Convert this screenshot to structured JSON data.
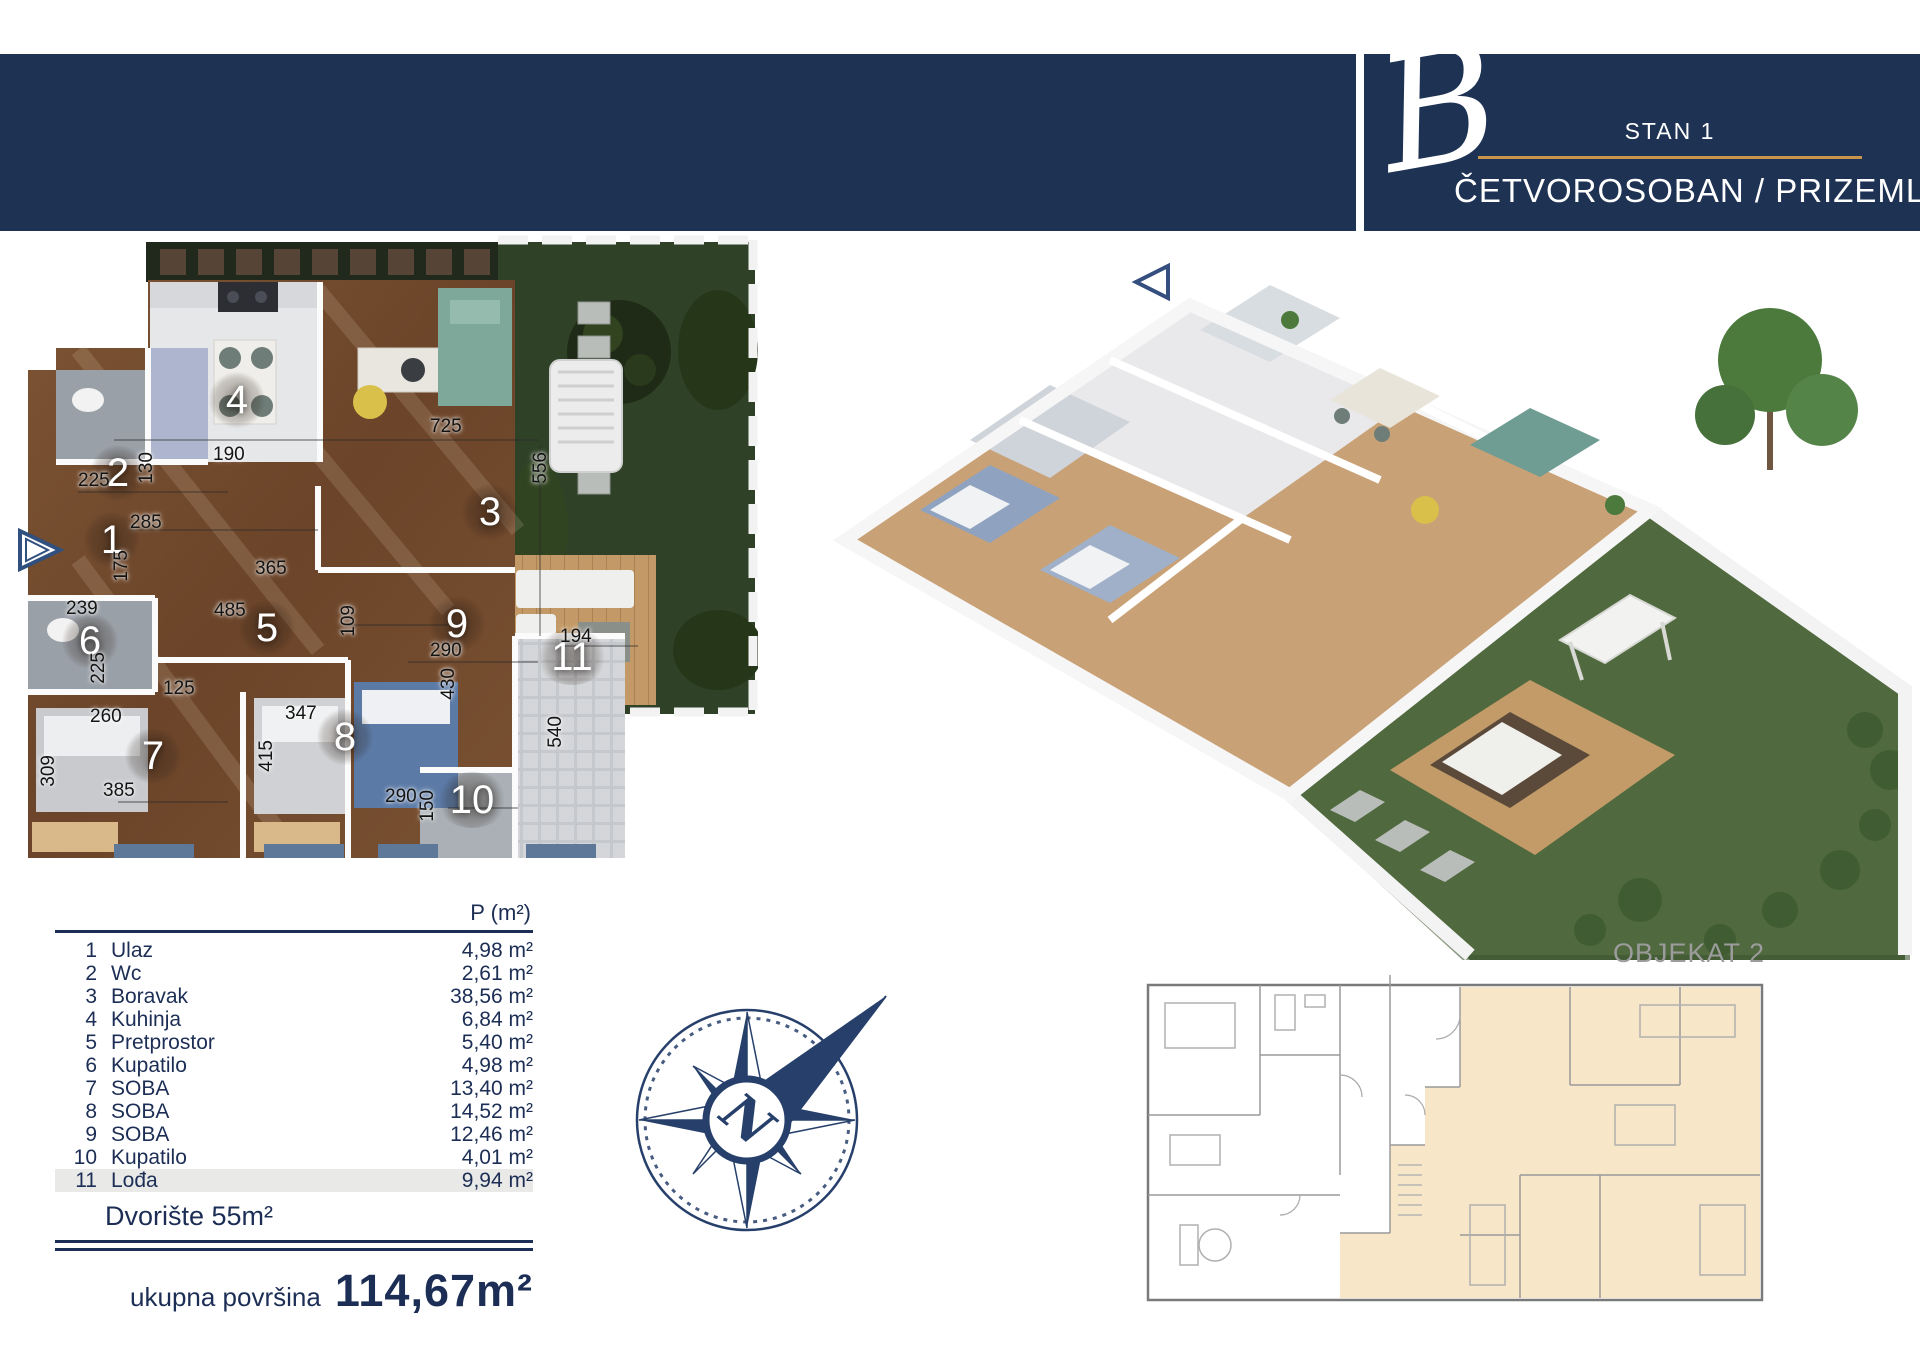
{
  "header": {
    "logo_glyph": "B",
    "unit_label": "STAN 1",
    "subtitle": "ČETVOROSOBAN / PRIZEMLJE"
  },
  "plan2d": {
    "rooms": [
      {
        "n": "1"
      },
      {
        "n": "2"
      },
      {
        "n": "3"
      },
      {
        "n": "4"
      },
      {
        "n": "5"
      },
      {
        "n": "6"
      },
      {
        "n": "7"
      },
      {
        "n": "8"
      },
      {
        "n": "9"
      },
      {
        "n": "10"
      },
      {
        "n": "11"
      }
    ],
    "dims": [
      {
        "t": "725"
      },
      {
        "t": "556"
      },
      {
        "t": "190"
      },
      {
        "t": "130"
      },
      {
        "t": "225"
      },
      {
        "t": "285"
      },
      {
        "t": "175"
      },
      {
        "t": "365"
      },
      {
        "t": "485"
      },
      {
        "t": "239"
      },
      {
        "t": "109"
      },
      {
        "t": "225"
      },
      {
        "t": "125"
      },
      {
        "t": "260"
      },
      {
        "t": "347"
      },
      {
        "t": "290"
      },
      {
        "t": "430"
      },
      {
        "t": "194"
      },
      {
        "t": "540"
      },
      {
        "t": "309"
      },
      {
        "t": "385"
      },
      {
        "t": "415"
      },
      {
        "t": "290"
      },
      {
        "t": "150"
      }
    ]
  },
  "table": {
    "area_header": "P (m²)",
    "rows": [
      {
        "num": "1",
        "name": "Ulaz",
        "area": "4,98 m²"
      },
      {
        "num": "2",
        "name": "Wc",
        "area": "2,61 m²"
      },
      {
        "num": "3",
        "name": "Boravak",
        "area": "38,56 m²"
      },
      {
        "num": "4",
        "name": "Kuhinja",
        "area": "6,84 m²"
      },
      {
        "num": "5",
        "name": "Pretprostor",
        "area": "5,40 m²"
      },
      {
        "num": "6",
        "name": "Kupatilo",
        "area": "4,98 m²"
      },
      {
        "num": "7",
        "name": "SOBA",
        "area": "13,40 m²"
      },
      {
        "num": "8",
        "name": "SOBA",
        "area": "14,52 m²"
      },
      {
        "num": "9",
        "name": "SOBA",
        "area": "12,46 m²"
      },
      {
        "num": "10",
        "name": "Kupatilo",
        "area": "4,01 m²"
      },
      {
        "num": "11",
        "name": "Lođa",
        "area": "9,94 m²"
      }
    ],
    "yard_note": "Dvorište 55m²",
    "total_label": "ukupna površina",
    "total_value": "114,67m²"
  },
  "siteplan": {
    "label": "OBJEKAT 2"
  },
  "compass": {
    "north_letter": "N"
  },
  "colors": {
    "navy": "#1e3254",
    "gold": "#c8954a",
    "table_text": "#1c2e55",
    "peach": "#f7e6c8"
  }
}
